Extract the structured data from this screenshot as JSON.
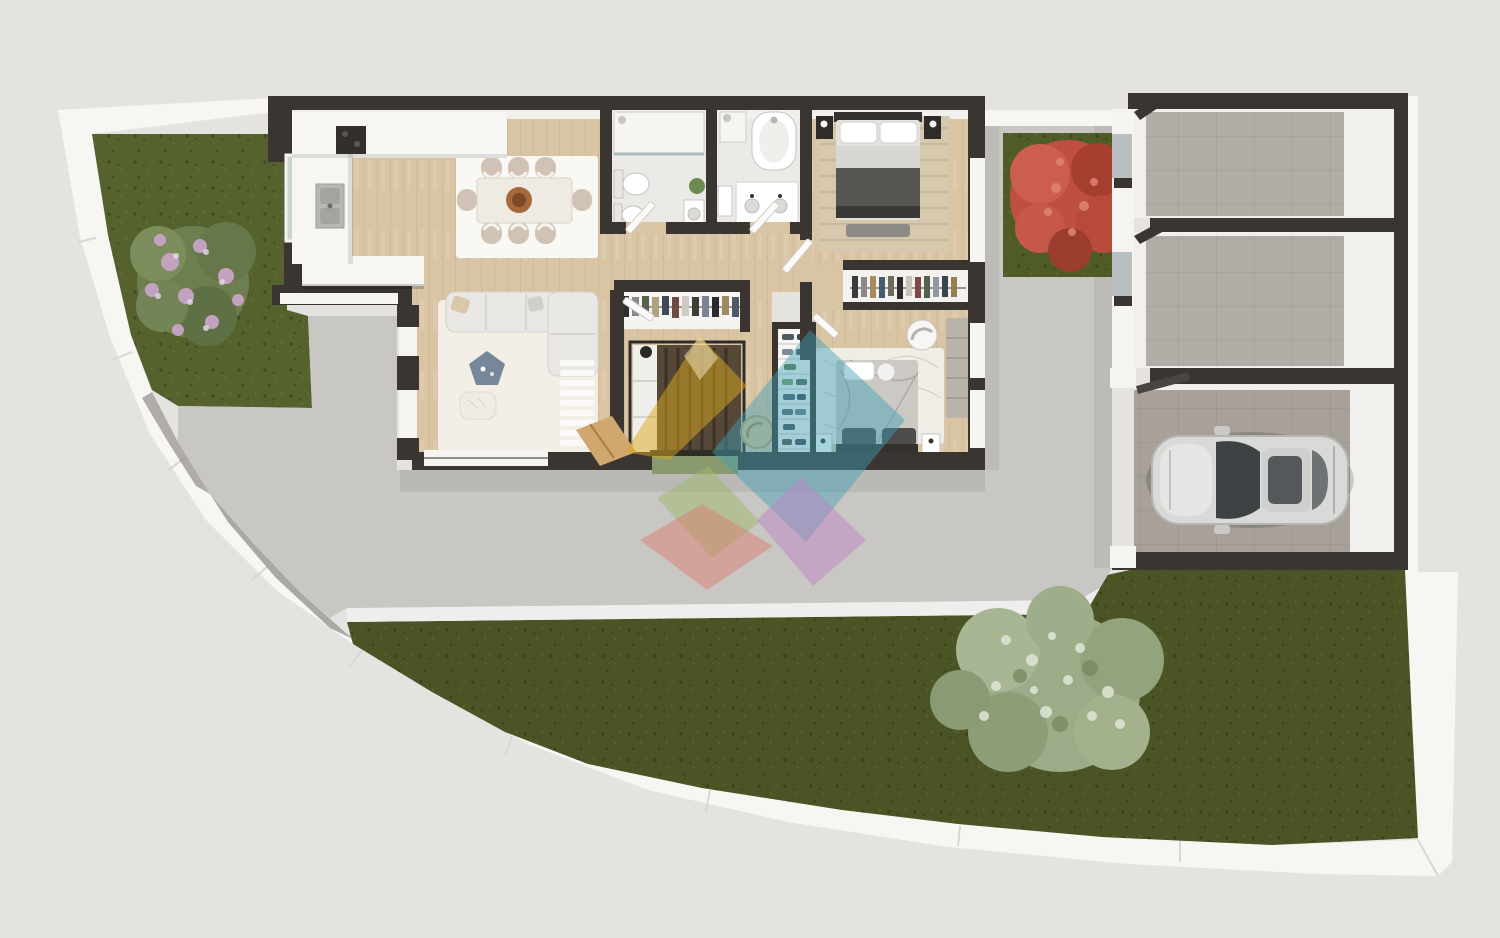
{
  "scene": {
    "kind": "3d-top-down-floor-plan-render",
    "lot": "irregular plot with curved white boundary wall",
    "counts": {
      "bedrooms": 3,
      "bathrooms": 2,
      "dining_chairs": 8,
      "storage_rooms": 2,
      "cars": 1,
      "trees": 3,
      "watermark_diamonds": 5
    }
  },
  "colors": {
    "background": "#e4e3e0",
    "boundary_wall": "#f7f6f3",
    "boundary_shadow": "#8f8d8a",
    "concrete": "#c9c7c4",
    "path": "#efeeec",
    "grass_front": "#55622e",
    "grass_back": "#4a5424",
    "grass_patch": "#4f5c28",
    "house_wall": "#3a3530",
    "inner_wall": "#f3f1ee",
    "wood_floor": "#d9c4a4",
    "bathroom_floor": "#eceae7",
    "closet_floor": "#f4f2ef",
    "rug_dining": "#faf8f5",
    "rug_living": "#f3efe7",
    "rug_bedroom1": "#d6c8ad",
    "rug_bedroom3": "#f0ede7",
    "sofa": "#eae8e4",
    "dining_table": "#efeae2",
    "chair": "#d0c3b5",
    "bowl": "#a5693d",
    "counter": "#f7f6f3",
    "cooktop": "#33302c",
    "bed1_blanket": "#575551",
    "bed2_blanket": "#564838",
    "bed3_blanket": "#ccc9c4",
    "mat": "#8a9a6e",
    "ramp_wood": "#cfa76f",
    "tree_green": "#6d7f4e",
    "tree_blossom": "#c3a2c0",
    "tree_red": "#bf4f40",
    "tree_sage": "#9dac88",
    "tile_storage": "#b2ada7",
    "tile_garage": "#a7a19a",
    "car_body": "#d9d9d7",
    "car_glass": "#3f4245",
    "wm_yellow": "#d9a81c",
    "wm_teal": "#3f9fb5",
    "wm_green": "#9cb86a",
    "wm_red": "#d97f70",
    "wm_purple": "#bb85c4"
  }
}
